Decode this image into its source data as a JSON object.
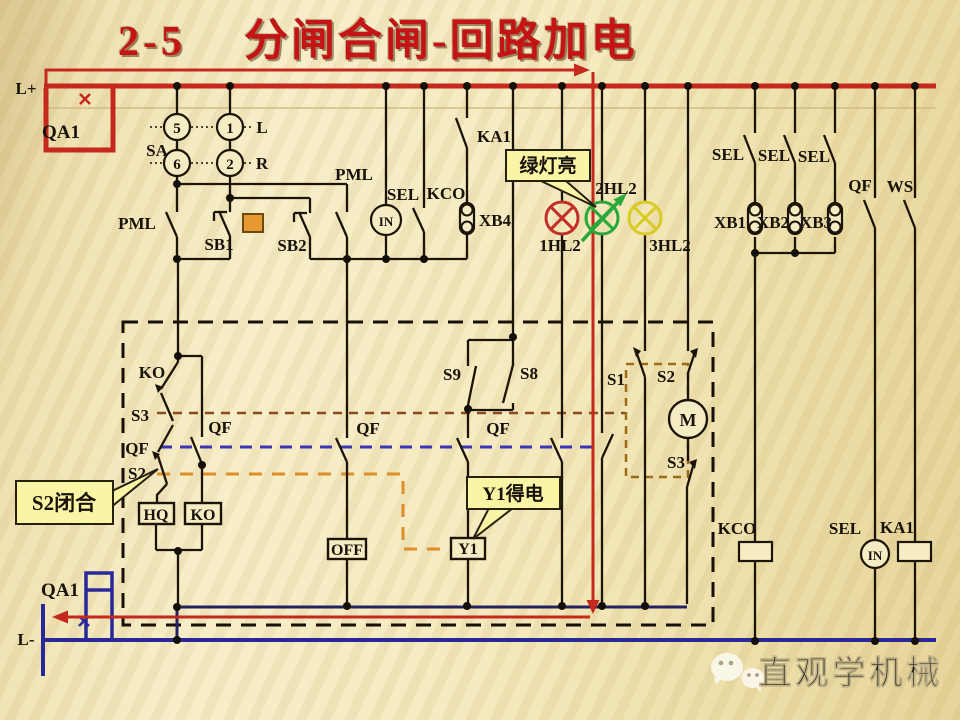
{
  "title": {
    "number": "2-5",
    "text": "分闸合闸-回路加电"
  },
  "colors": {
    "energized_path": "#c5281c",
    "negative_bus": "#28289b",
    "wire": "#1c1408",
    "lamp_red": "#c03028",
    "lamp_green": "#28a838",
    "lamp_yellow": "#d8cc24",
    "callout_bg": "#faf5a4"
  },
  "buses": {
    "positive": "L+",
    "negative": "L-"
  },
  "labels": {
    "l_plus": "L+",
    "qa1_top": "QA1",
    "sa": "SA",
    "sa5": "5",
    "sa1": "1",
    "sa6": "6",
    "sa2": "2",
    "sa_l": "L",
    "sa_r": "R",
    "pml_left": "PML",
    "sb1": "SB1",
    "sb2": "SB2",
    "pml_mid": "PML",
    "sel_mid": "SEL",
    "kco_mid": "KCO",
    "in_mid": "IN",
    "xb4": "XB4",
    "ka1_top": "KA1",
    "hl1": "1HL2",
    "hl2": "2HL2",
    "hl3": "3HL2",
    "sel_r1": "SEL",
    "sel_r2": "SEL",
    "sel_r3": "SEL",
    "xb1": "XB1",
    "xb2": "XB2",
    "xb3": "XB3",
    "qf_top": "QF",
    "ws": "WS",
    "ko_contact": "KO",
    "s3_left": "S3",
    "qf_left": "QF",
    "s2_left": "S2",
    "qf_branch": "QF",
    "hq": "HQ",
    "ko_coil": "KO",
    "off": "OFF",
    "s9": "S9",
    "s8": "S8",
    "qf_mid_left": "QF",
    "qf_mid": "QF",
    "y1": "Y1",
    "s1": "S1",
    "s2_right": "S2",
    "motor": "M",
    "s3_right": "S3",
    "kco_coil": "KCO",
    "sel_bottom": "SEL",
    "in_bottom": "IN",
    "ka1_coil": "KA1",
    "qa1_bottom": "QA1",
    "l_minus": "L-"
  },
  "callouts": {
    "green": "绿灯亮",
    "s2": "S2闭合",
    "y1": "Y1得电"
  },
  "watermark": {
    "brand": "直观学机械"
  }
}
